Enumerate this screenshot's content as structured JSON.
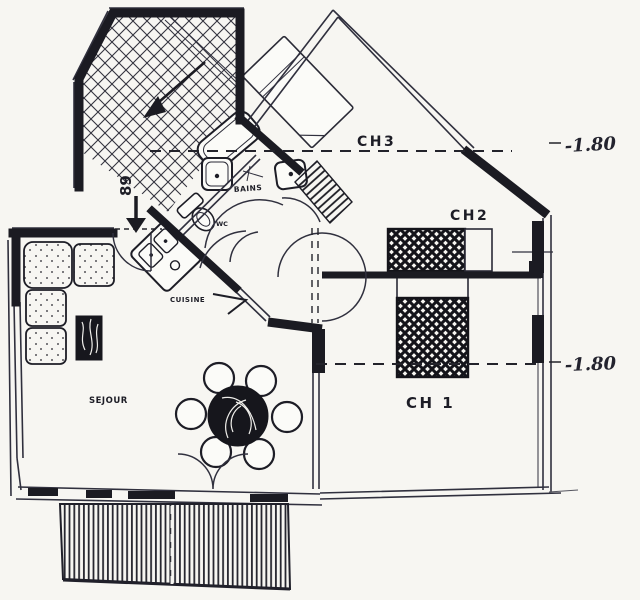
{
  "plan": {
    "title": "apartment-floor-plan-scan",
    "rooms": {
      "sejour": {
        "label": "SEJOUR"
      },
      "cuisine": {
        "label": "CUISINE"
      },
      "bains": {
        "label": "BAINS"
      },
      "wc": {
        "label": "WC"
      },
      "ch1": {
        "label": "CH 1"
      },
      "ch2": {
        "label": "CH2"
      },
      "ch3": {
        "label": "CH3"
      }
    },
    "annotations": {
      "entry_number": "89",
      "height_marker_upper": "-1.80",
      "height_marker_lower": "-1.80"
    },
    "colors": {
      "ink": "#1d1d26",
      "paper": "#f7f6f2"
    }
  }
}
